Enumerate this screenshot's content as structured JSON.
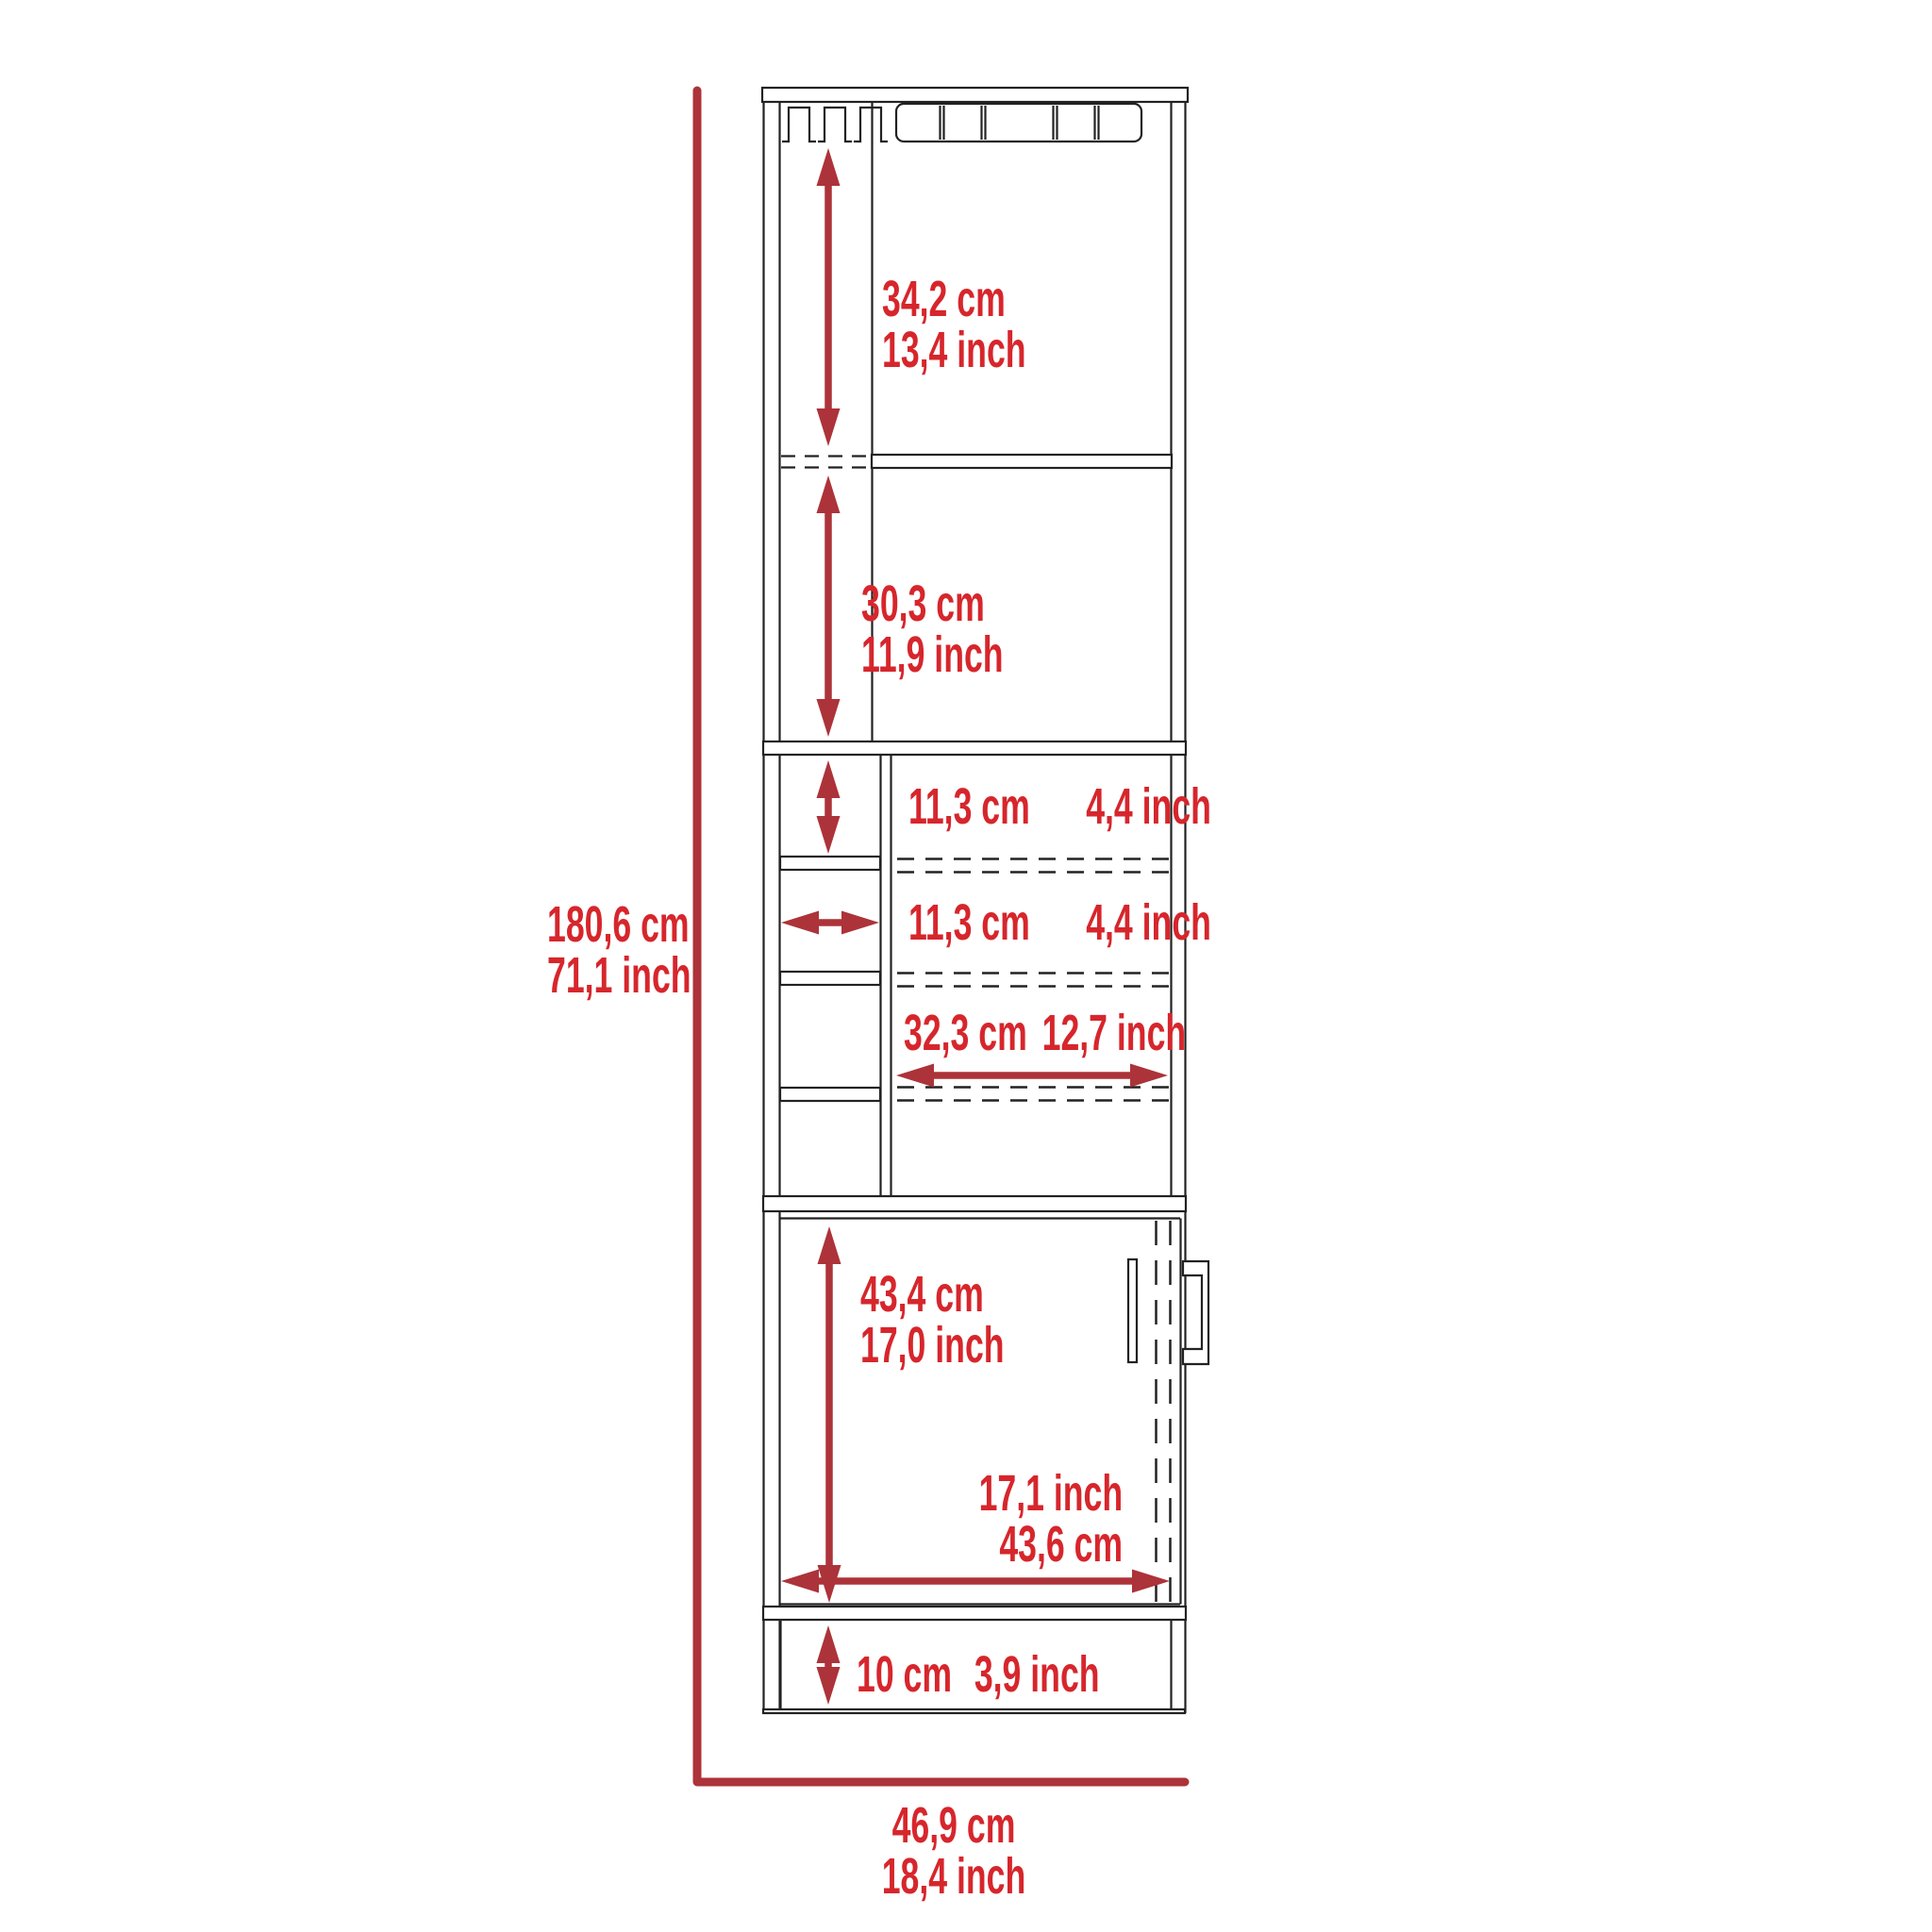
{
  "title": "Bar cabinet dimension diagram",
  "colors": {
    "dimension_red": "#ac3339",
    "label_red": "#d6262c",
    "line_black": "#222222"
  },
  "labels": {
    "overall_height": {
      "cm": "180,6 cm",
      "inch": "71,1 inch"
    },
    "overall_width": {
      "cm": "46,9 cm",
      "inch": "18,4 inch"
    },
    "top_section": {
      "cm": "34,2 cm",
      "inch": "13,4 inch"
    },
    "second_section": {
      "cm": "30,3 cm",
      "inch": "11,9 inch"
    },
    "cubby_height": {
      "cm": "11,3 cm",
      "inch": "4,4 inch"
    },
    "cubby_width": {
      "cm": "11,3 cm",
      "inch": "4,4 inch"
    },
    "shelf_width": {
      "cm": "32,3 cm",
      "inch": "12,7 inch"
    },
    "door_height": {
      "cm": "43,4 cm",
      "inch": "17,0 inch"
    },
    "door_width": {
      "inch": "17,1 inch",
      "cm": "43,6 cm"
    },
    "base_height": {
      "cm": "10 cm",
      "inch": "3,9 inch"
    }
  }
}
